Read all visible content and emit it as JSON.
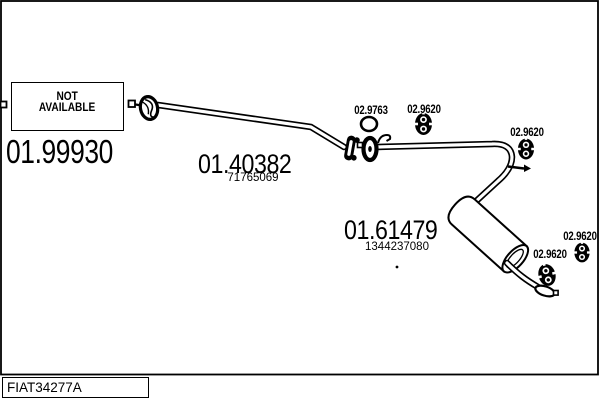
{
  "diagram": {
    "code": "FIAT34277A",
    "unavailable_part": {
      "label_line1": "NOT",
      "label_line2": "AVAILABLE",
      "part_number": "01.99930"
    },
    "parts": [
      {
        "part_number": "01.40382",
        "oem_number": "71765069"
      },
      {
        "part_number": "01.61479",
        "oem_number": "1344237080"
      }
    ],
    "fittings": {
      "gasket_ring": "02.9763",
      "hanger_mid": "02.9620",
      "hanger_bend": "02.9620",
      "hanger_tail_left": "02.9620",
      "hanger_tail_right": "02.9620"
    },
    "colors": {
      "ink": "#000000",
      "background": "#ffffff"
    }
  }
}
